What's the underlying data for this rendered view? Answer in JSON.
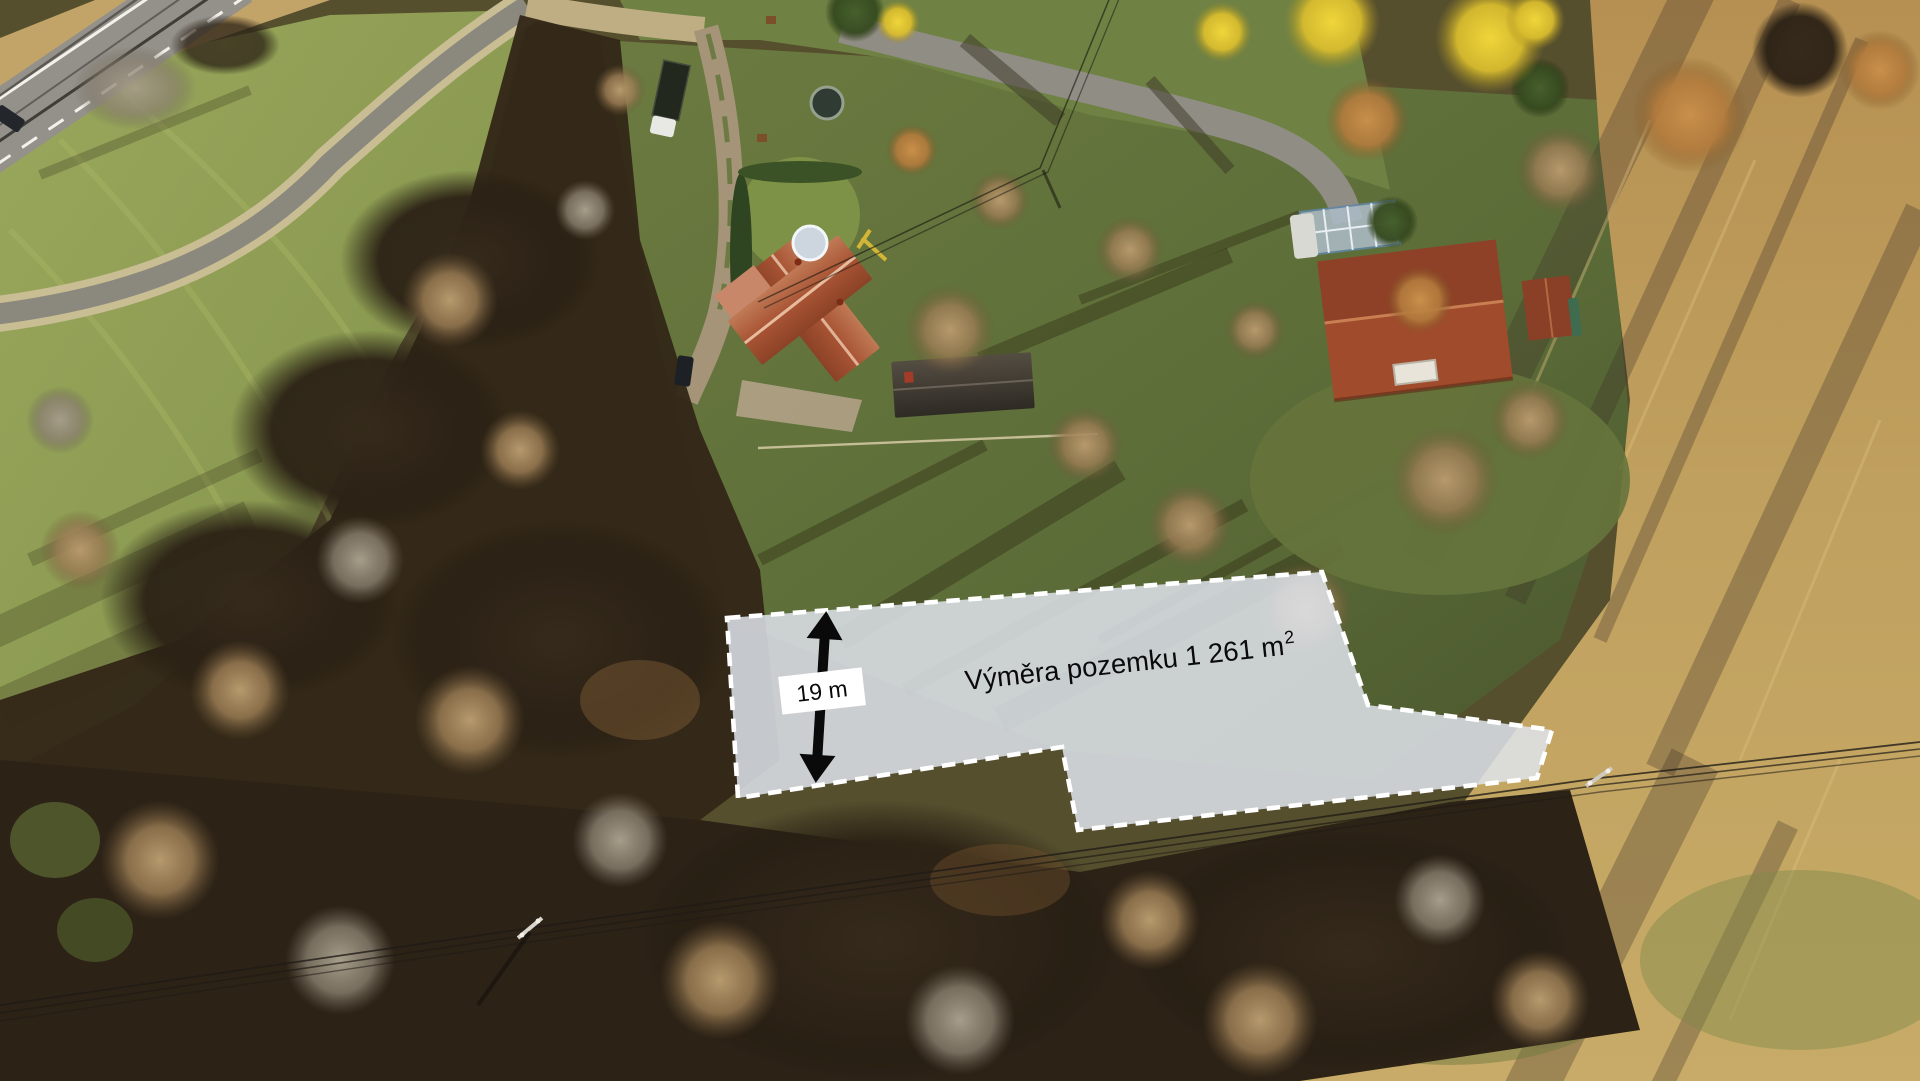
{
  "overlay": {
    "area_label": {
      "text": "Výměra pozemku 1 261 m",
      "superscript": "2",
      "color": "#0a0a0a"
    },
    "dimension_label": {
      "text": "19 m",
      "color": "#0a0a0a",
      "box": {
        "x": "780",
        "y": "672",
        "w": "84",
        "h": "38",
        "fill": "#ffffff"
      }
    },
    "parcel": {
      "points": "727,618 1322,572 1368,705 1552,730 1537,778 1078,830 1062,747 738,798",
      "fill": "#dfe4ec",
      "fill_opacity": "0.85",
      "stroke": "#ffffff"
    },
    "arrow": {
      "path": "M821,611 L839,639 L826,639 L826,755 L839,755 L821,783 L803,755 L816,755 L816,639 L803,639 Z",
      "fill": "#0a0a0a"
    }
  }
}
